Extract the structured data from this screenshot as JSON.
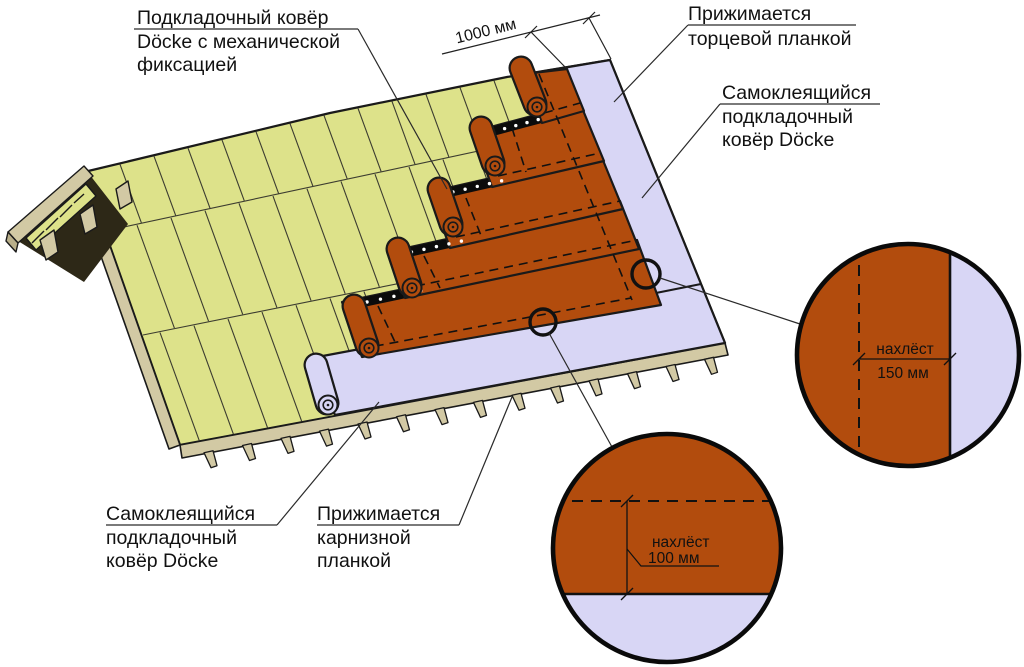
{
  "colors": {
    "membrane": "#b24c0d",
    "self_adhesive_underlay": "#d8d6f5",
    "deck": "#dde28a",
    "wood": "#d2c9a4",
    "line": "#1a1a1a"
  },
  "labels": {
    "underlay_mech": {
      "lines": [
        "Подкладочный ковёр",
        "Döcke с механической",
        "фиксацией"
      ]
    },
    "end_strip": {
      "lines": [
        "Прижимается",
        "торцевой планкой"
      ]
    },
    "selfadh_right": {
      "lines": [
        "Самоклеящийся",
        "подкладочный",
        "ковёр Döcke"
      ]
    },
    "selfadh_left": {
      "lines": [
        "Самоклеящийся",
        "подкладочный",
        "ковёр Döcke"
      ]
    },
    "eaves_strip": {
      "lines": [
        "Прижимается",
        "карнизной",
        "планкой"
      ]
    }
  },
  "dimensions": {
    "course_width": "1000 мм",
    "overlap_side": {
      "line1": "нахлёст",
      "line2": "150 мм"
    },
    "overlap_end": {
      "line1": "нахлёст",
      "line2": "100 мм"
    }
  }
}
